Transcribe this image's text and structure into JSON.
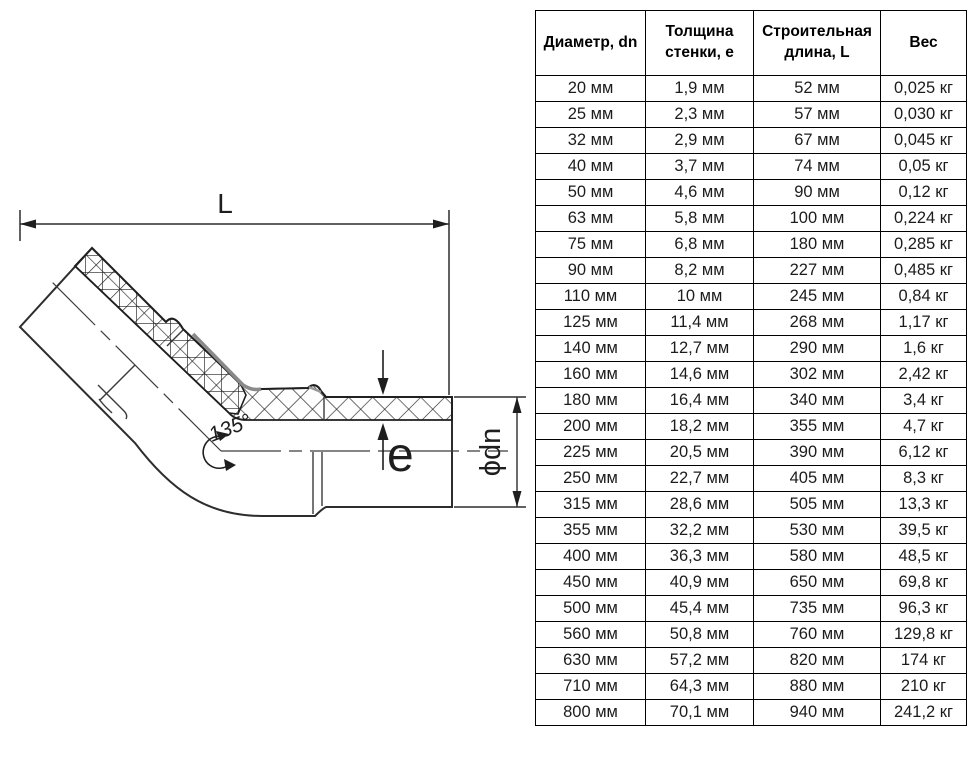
{
  "diagram": {
    "length_label": "L",
    "wall_label": "e",
    "diameter_label": "ϕdn",
    "angle_label": "135°",
    "line_color": "#2d2d2d"
  },
  "table": {
    "headers": [
      "Диаметр, dn",
      "Толщина стенки, е",
      "Строительная длина, L",
      "Вес"
    ],
    "rows": [
      [
        "20 мм",
        "1,9 мм",
        "52 мм",
        "0,025 кг"
      ],
      [
        "25 мм",
        "2,3 мм",
        "57 мм",
        "0,030 кг"
      ],
      [
        "32 мм",
        "2,9 мм",
        "67 мм",
        "0,045 кг"
      ],
      [
        "40 мм",
        "3,7 мм",
        "74 мм",
        "0,05 кг"
      ],
      [
        "50 мм",
        "4,6 мм",
        "90 мм",
        "0,12 кг"
      ],
      [
        "63 мм",
        "5,8 мм",
        "100 мм",
        "0,224 кг"
      ],
      [
        "75 мм",
        "6,8 мм",
        "180 мм",
        "0,285 кг"
      ],
      [
        "90 мм",
        "8,2 мм",
        "227 мм",
        "0,485 кг"
      ],
      [
        "110 мм",
        "10 мм",
        "245 мм",
        "0,84 кг"
      ],
      [
        "125 мм",
        "11,4 мм",
        "268 мм",
        "1,17 кг"
      ],
      [
        "140 мм",
        "12,7 мм",
        "290 мм",
        "1,6 кг"
      ],
      [
        "160 мм",
        "14,6 мм",
        "302 мм",
        "2,42 кг"
      ],
      [
        "180 мм",
        "16,4 мм",
        "340 мм",
        "3,4 кг"
      ],
      [
        "200 мм",
        "18,2 мм",
        "355 мм",
        "4,7 кг"
      ],
      [
        "225 мм",
        "20,5 мм",
        "390 мм",
        "6,12 кг"
      ],
      [
        "250 мм",
        "22,7 мм",
        "405 мм",
        "8,3 кг"
      ],
      [
        "315 мм",
        "28,6 мм",
        "505 мм",
        "13,3 кг"
      ],
      [
        "355 мм",
        "32,2 мм",
        "530 мм",
        "39,5 кг"
      ],
      [
        "400 мм",
        "36,3 мм",
        "580 мм",
        "48,5 кг"
      ],
      [
        "450 мм",
        "40,9 мм",
        "650 мм",
        "69,8 кг"
      ],
      [
        "500 мм",
        "45,4 мм",
        "735 мм",
        "96,3 кг"
      ],
      [
        "560 мм",
        "50,8 мм",
        "760 мм",
        "129,8 кг"
      ],
      [
        "630 мм",
        "57,2 мм",
        "820 мм",
        "174 кг"
      ],
      [
        "710 мм",
        "64,3 мм",
        "880 мм",
        "210 кг"
      ],
      [
        "800 мм",
        "70,1 мм",
        "940 мм",
        "241,2 кг"
      ]
    ]
  }
}
